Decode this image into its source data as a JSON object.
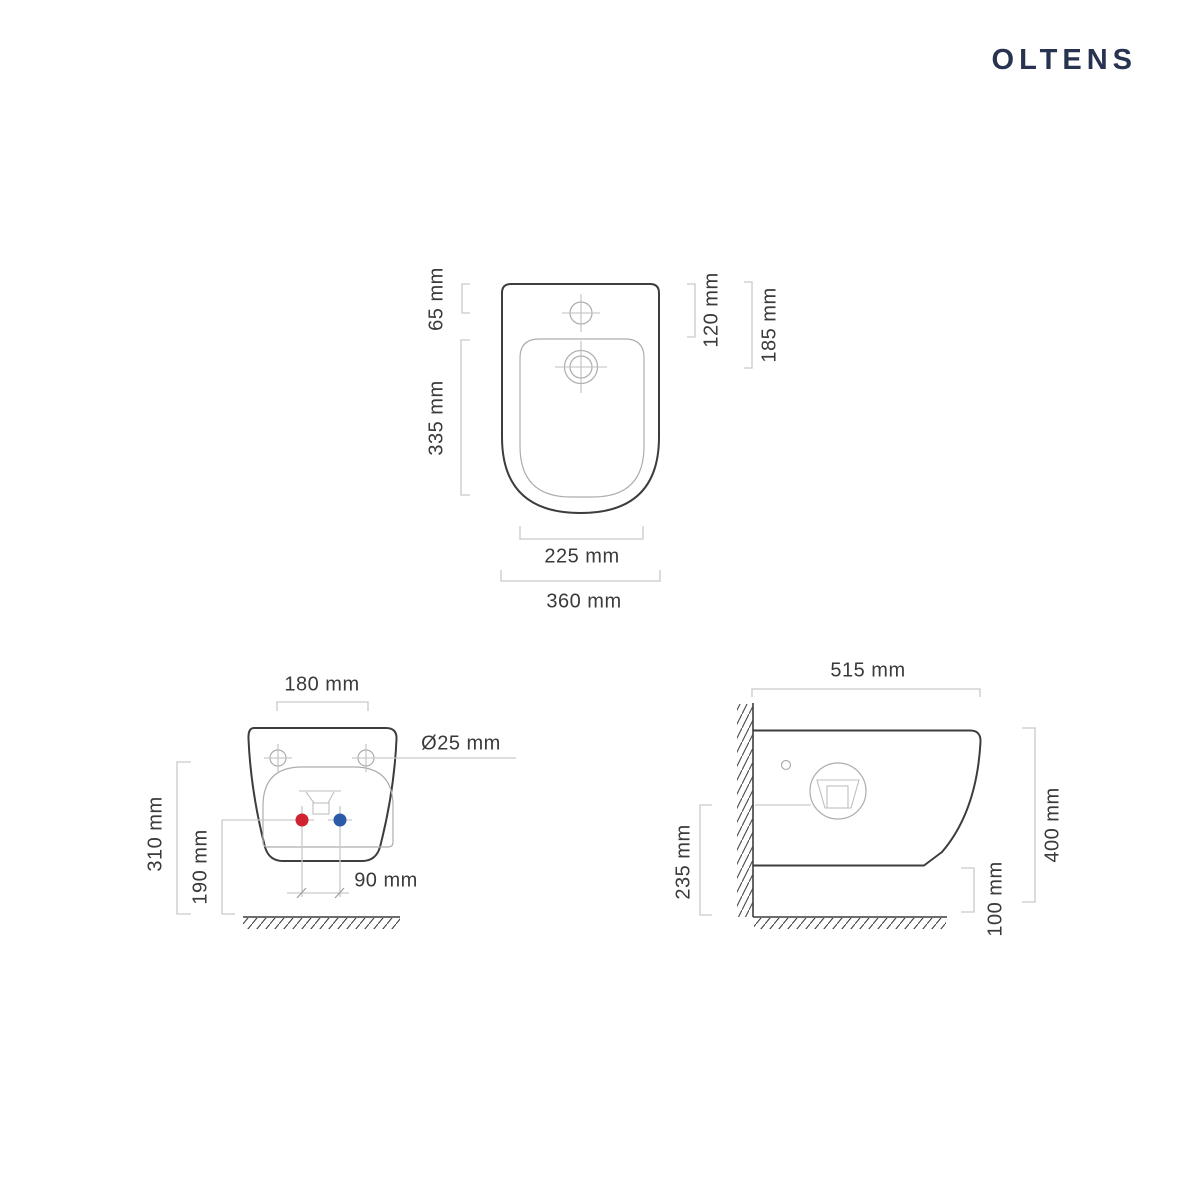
{
  "brand": {
    "name": "OLTENS"
  },
  "colors": {
    "brand": "#273350",
    "outline": "#3d3d3d",
    "detail_line": "#adadad",
    "dim_line": "#c9c9c9",
    "label_text": "#3a3a3a",
    "hot_water": "#d02330",
    "cold_water": "#2b5aa7"
  },
  "top_view": {
    "front_edge_to_tap": "65 mm",
    "basin_length": "335 mm",
    "tap_to_drain": "120 mm",
    "drain_offset": "185 mm",
    "basin_width": "225 mm",
    "overall_width": "360 mm"
  },
  "front_view": {
    "mounting_hole_spacing": "180 mm",
    "mounting_hole_diameter": "Ø25 mm",
    "mounting_hole_height": "310 mm",
    "water_inlet_height": "190 mm",
    "water_inlet_spacing": "90 mm"
  },
  "side_view": {
    "overall_depth": "515 mm",
    "spout_axis_height": "235 mm",
    "overall_height": "400 mm",
    "floor_clearance": "100 mm"
  }
}
